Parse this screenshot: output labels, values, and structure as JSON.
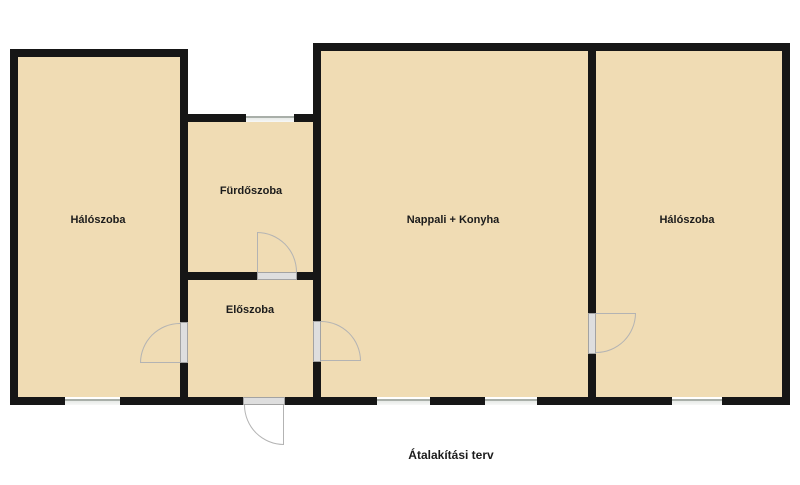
{
  "caption": "Átalakítási terv",
  "rooms": {
    "bedroom_left": {
      "label": "Hálószoba"
    },
    "bathroom": {
      "label": "Fürdőszoba"
    },
    "hallway": {
      "label": "Előszoba"
    },
    "living_kitchen": {
      "label": "Nappali + Konyha"
    },
    "bedroom_right": {
      "label": "Hálószoba"
    }
  },
  "colors": {
    "room_fill": "#f0dcb4",
    "wall": "#161616",
    "label_text": "#1c1c1c",
    "door_arc": "#b3b3b3",
    "window_line": "#a9afa9",
    "door_slab": "#dedede",
    "background": "#ffffff"
  }
}
